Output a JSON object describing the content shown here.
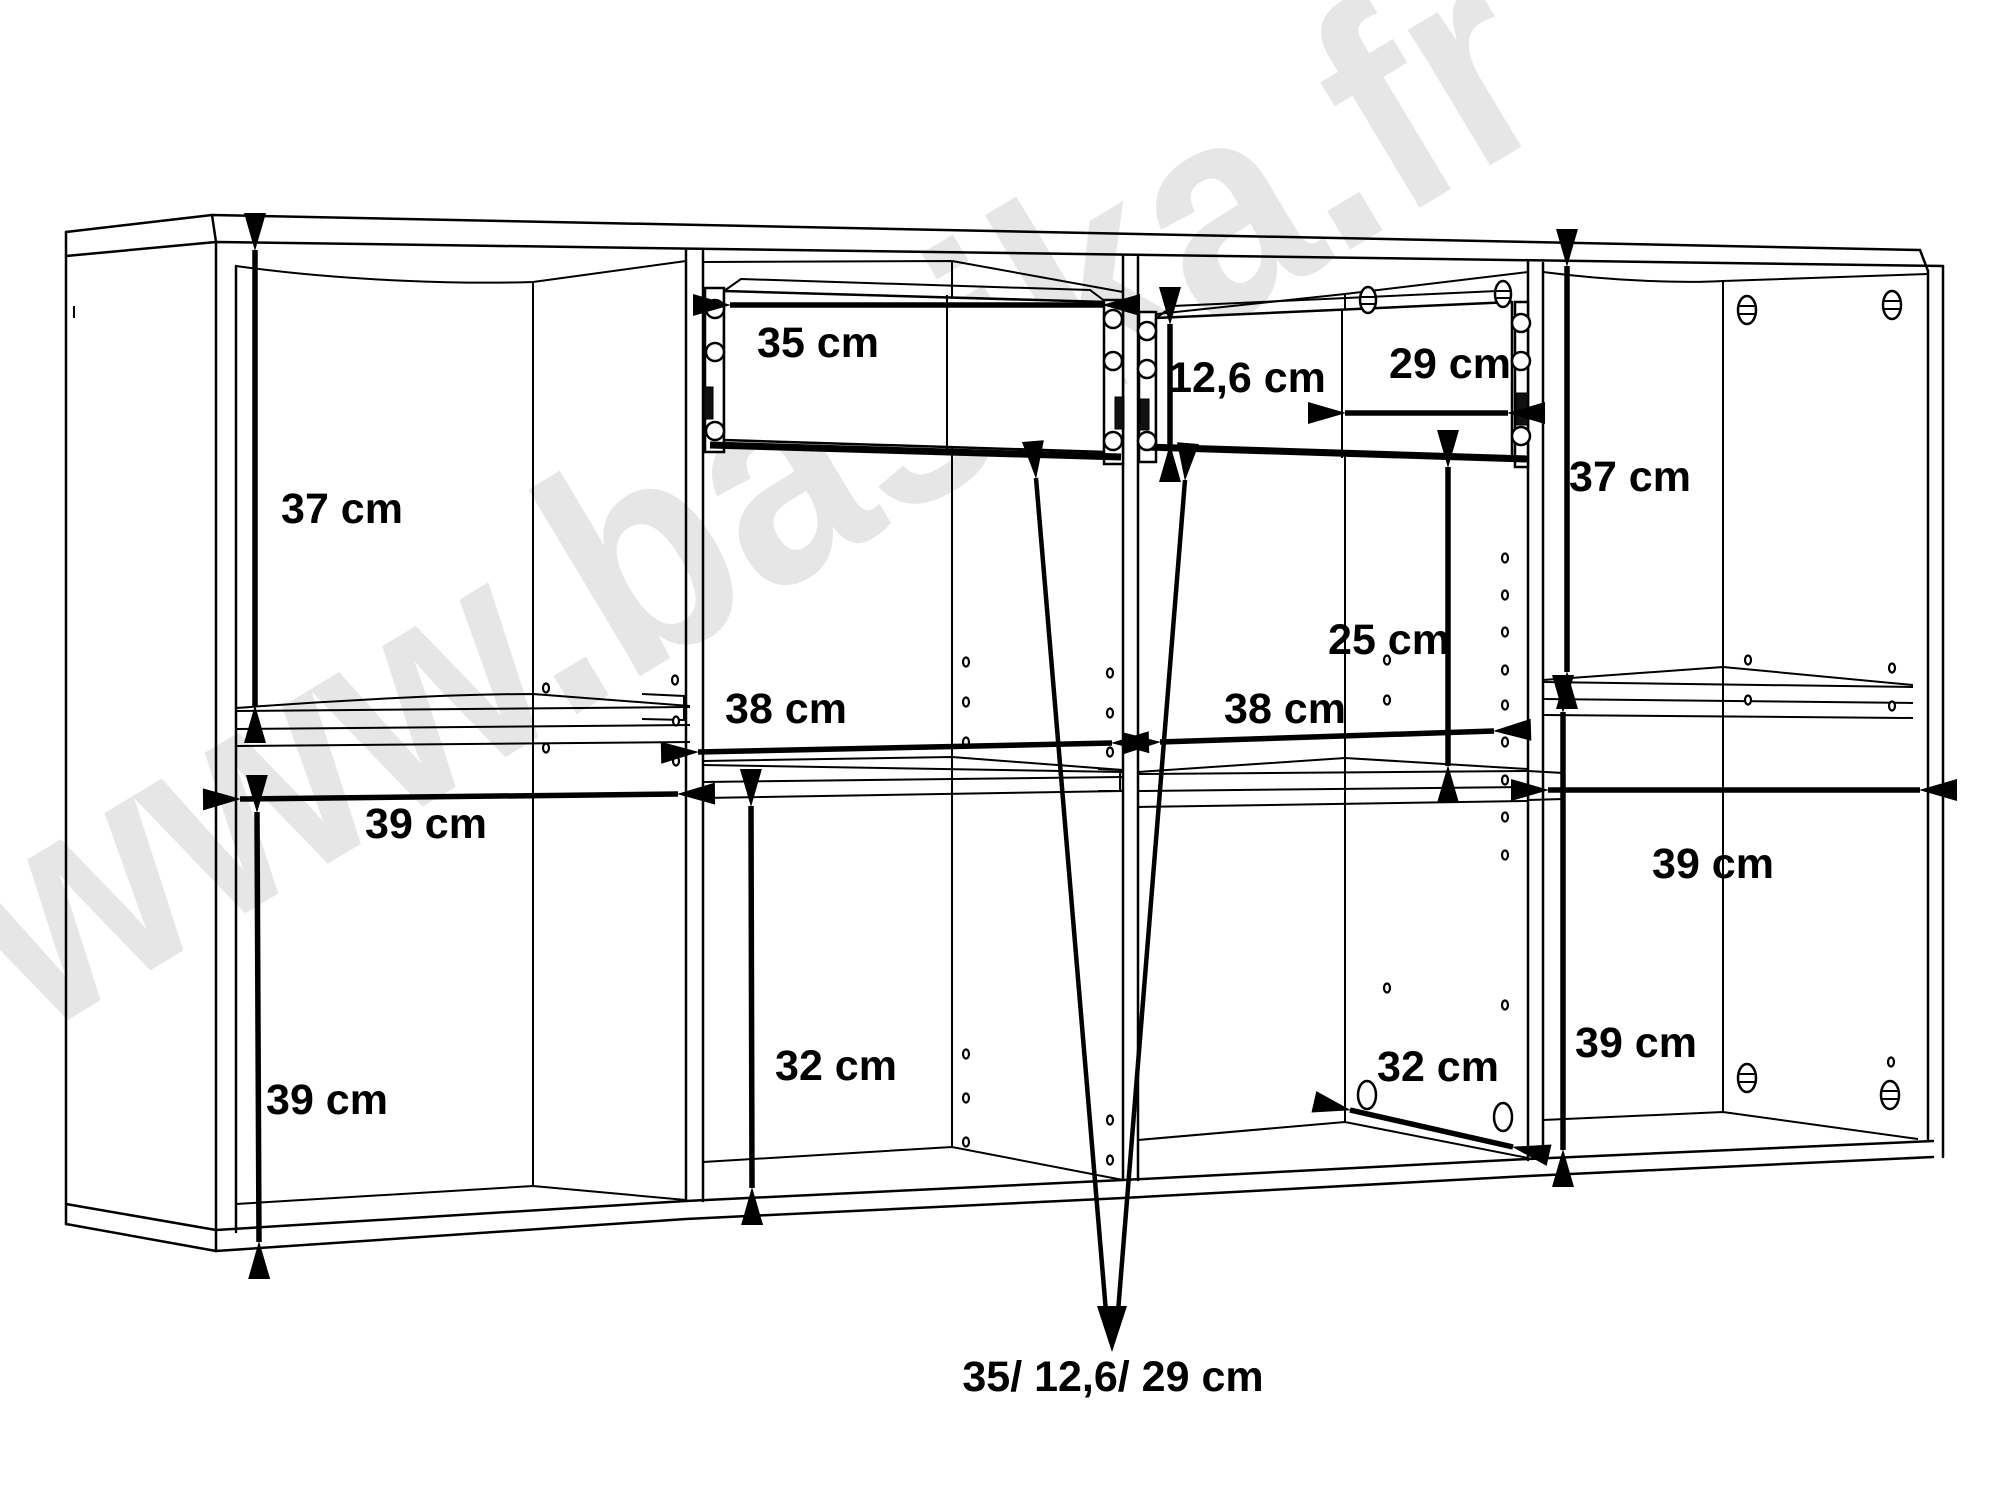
{
  "diagram": {
    "type": "furniture-dimension-drawing",
    "unit": "cm",
    "watermark": {
      "text": "www.basika.fr",
      "color": "#e6e6e6",
      "rotation_deg": -31
    },
    "colors": {
      "background": "#ffffff",
      "line": "#000000",
      "label": "#000000"
    },
    "dimensions": [
      {
        "id": "left-top-height",
        "text": "37 cm",
        "value": 37
      },
      {
        "id": "left-width",
        "text": "39 cm",
        "value": 39
      },
      {
        "id": "left-bottom-height",
        "text": "39 cm",
        "value": 39
      },
      {
        "id": "drawer1-width",
        "text": "35 cm",
        "value": 35
      },
      {
        "id": "mid-left-width",
        "text": "38 cm",
        "value": 38
      },
      {
        "id": "mid-left-bottom-height",
        "text": "32 cm",
        "value": 32
      },
      {
        "id": "drawer2-front-height",
        "text": "12,6 cm",
        "value": 12.6
      },
      {
        "id": "drawer2-width",
        "text": "29 cm",
        "value": 29
      },
      {
        "id": "mid-right-width",
        "text": "38 cm",
        "value": 38
      },
      {
        "id": "mid-right-upper-height",
        "text": "25 cm",
        "value": 25
      },
      {
        "id": "right-top-height",
        "text": "37 cm",
        "value": 37
      },
      {
        "id": "right-width",
        "text": "39 cm",
        "value": 39
      },
      {
        "id": "right-bottom-height",
        "text": "39 cm",
        "value": 39
      },
      {
        "id": "mid-right-depth",
        "text": "32 cm",
        "value": 32
      }
    ],
    "drawer_callout": {
      "text": "35/ 12,6/ 29 cm",
      "values": [
        35,
        12.6,
        29
      ]
    }
  }
}
